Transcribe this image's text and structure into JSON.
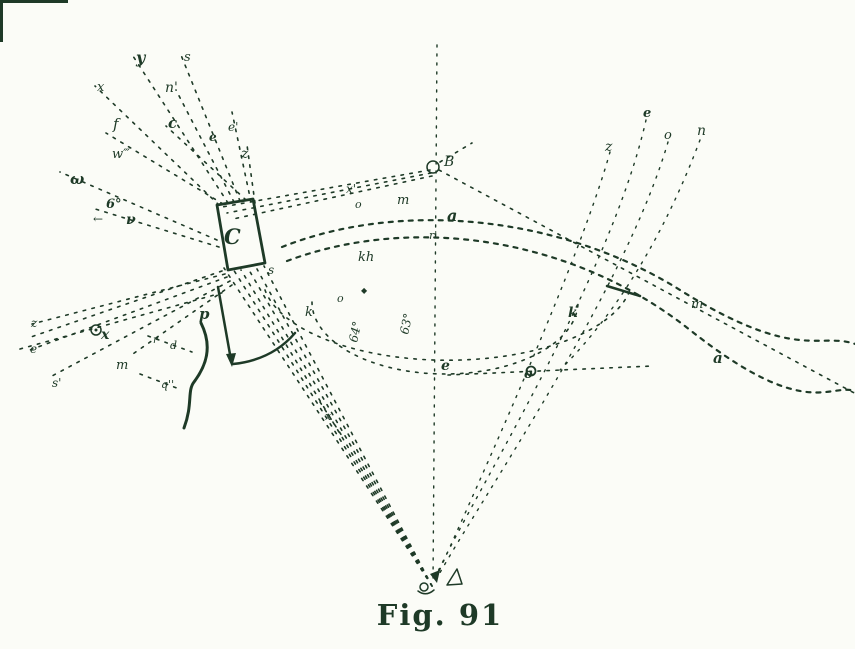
{
  "figure": {
    "caption": "Fig. 91",
    "number": "91",
    "type": "optical ray diagram with prism"
  },
  "colors": {
    "ink": "#1e3a27",
    "paper": "#fbfcf7"
  },
  "angle_annotations": [
    "6°",
    "64°",
    "63°"
  ],
  "labels": [
    {
      "t": "y",
      "x": 136,
      "y": 63,
      "s": 16,
      "b": 1
    },
    {
      "t": "s",
      "x": 184,
      "y": 61,
      "s": 13
    },
    {
      "t": "x",
      "x": 97,
      "y": 91,
      "s": 13
    },
    {
      "t": "n'",
      "x": 165,
      "y": 92,
      "s": 14
    },
    {
      "t": "f",
      "x": 113,
      "y": 129,
      "s": 15
    },
    {
      "t": "c",
      "x": 168,
      "y": 128,
      "s": 15,
      "b": 1
    },
    {
      "t": "e",
      "x": 209,
      "y": 141,
      "s": 12,
      "b": 1
    },
    {
      "t": "e'",
      "x": 228,
      "y": 131,
      "s": 12
    },
    {
      "t": "w‴",
      "x": 112,
      "y": 158,
      "s": 13
    },
    {
      "t": "z",
      "x": 241,
      "y": 158,
      "s": 14
    },
    {
      "t": "ω",
      "x": 70,
      "y": 184,
      "s": 15,
      "b": 1
    },
    {
      "t": "6°",
      "x": 106,
      "y": 208,
      "s": 13,
      "b": 1
    },
    {
      "t": "←",
      "x": 93,
      "y": 223,
      "s": 12
    },
    {
      "t": "ν",
      "x": 126,
      "y": 224,
      "s": 14,
      "b": 1
    },
    {
      "t": "z",
      "x": 31,
      "y": 327,
      "s": 12
    },
    {
      "t": "e",
      "x": 30,
      "y": 353,
      "s": 12
    },
    {
      "t": "s'",
      "x": 52,
      "y": 387,
      "s": 12
    },
    {
      "t": "x",
      "x": 101,
      "y": 339,
      "s": 14,
      "b": 1
    },
    {
      "t": "m",
      "x": 116,
      "y": 369,
      "s": 13
    },
    {
      "t": "r",
      "x": 153,
      "y": 343,
      "s": 10
    },
    {
      "t": "d",
      "x": 170,
      "y": 349,
      "s": 11
    },
    {
      "t": "q''",
      "x": 161,
      "y": 388,
      "s": 11
    },
    {
      "t": "x",
      "x": 325,
      "y": 420,
      "s": 11
    },
    {
      "t": "C",
      "x": 224,
      "y": 244,
      "s": 21,
      "b": 1
    },
    {
      "t": "s",
      "x": 268,
      "y": 274,
      "s": 12
    },
    {
      "t": "p",
      "x": 199,
      "y": 319,
      "s": 15,
      "b": 1
    },
    {
      "t": "k",
      "x": 305,
      "y": 316,
      "s": 13
    },
    {
      "t": "64°",
      "x": 357,
      "y": 343,
      "s": 12,
      "r": -78
    },
    {
      "t": "63°",
      "x": 408,
      "y": 335,
      "s": 12,
      "r": -78
    },
    {
      "t": "o",
      "x": 337,
      "y": 302,
      "s": 11
    },
    {
      "t": "◆",
      "x": 361,
      "y": 293,
      "s": 8
    },
    {
      "t": "x'",
      "x": 346,
      "y": 193,
      "s": 12
    },
    {
      "t": "o",
      "x": 355,
      "y": 208,
      "s": 11
    },
    {
      "t": "m",
      "x": 397,
      "y": 204,
      "s": 13
    },
    {
      "t": "a",
      "x": 447,
      "y": 221,
      "s": 16,
      "b": 1
    },
    {
      "t": "r'",
      "x": 429,
      "y": 239,
      "s": 11
    },
    {
      "t": "kh",
      "x": 358,
      "y": 261,
      "s": 13
    },
    {
      "t": "B",
      "x": 444,
      "y": 166,
      "s": 14
    },
    {
      "t": "e",
      "x": 441,
      "y": 370,
      "s": 14,
      "b": 1
    },
    {
      "t": "o",
      "x": 524,
      "y": 378,
      "s": 13,
      "b": 1
    },
    {
      "t": "z",
      "x": 605,
      "y": 151,
      "s": 14
    },
    {
      "t": "e",
      "x": 643,
      "y": 117,
      "s": 13,
      "b": 1
    },
    {
      "t": "o",
      "x": 664,
      "y": 139,
      "s": 13
    },
    {
      "t": "n",
      "x": 697,
      "y": 135,
      "s": 14
    },
    {
      "t": "k",
      "x": 568,
      "y": 317,
      "s": 14,
      "b": 1
    },
    {
      "t": "m",
      "x": 691,
      "y": 308,
      "s": 13
    },
    {
      "t": "a",
      "x": 713,
      "y": 363,
      "s": 15,
      "b": 1
    }
  ]
}
